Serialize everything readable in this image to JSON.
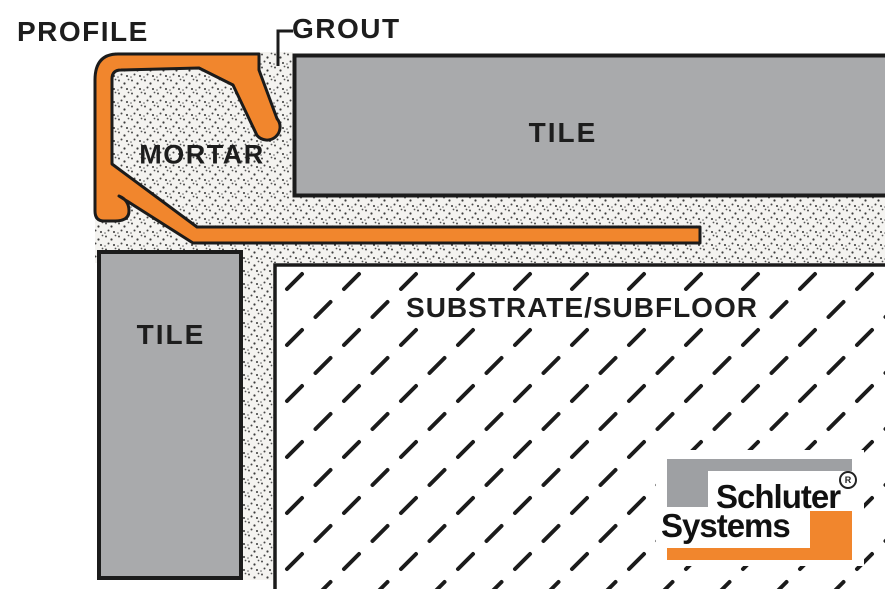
{
  "diagram": {
    "title": "Tile edge profile installation cross-section",
    "labels": {
      "profile": "PROFILE",
      "grout": "GROUT",
      "mortar": "MORTAR",
      "tile_top": "TILE",
      "tile_left": "TILE",
      "substrate": "SUBSTRATE/SUBFLOOR"
    },
    "logo": {
      "line1": "Schluter",
      "line2": "Systems",
      "registered_mark": "R"
    },
    "colors": {
      "profile_orange": "#F1862D",
      "tile_gray": "#A9AAAC",
      "logo_gray": "#9EA0A3",
      "outline_black": "#1B1B1B",
      "mortar_base": "#F4F3F0"
    }
  }
}
